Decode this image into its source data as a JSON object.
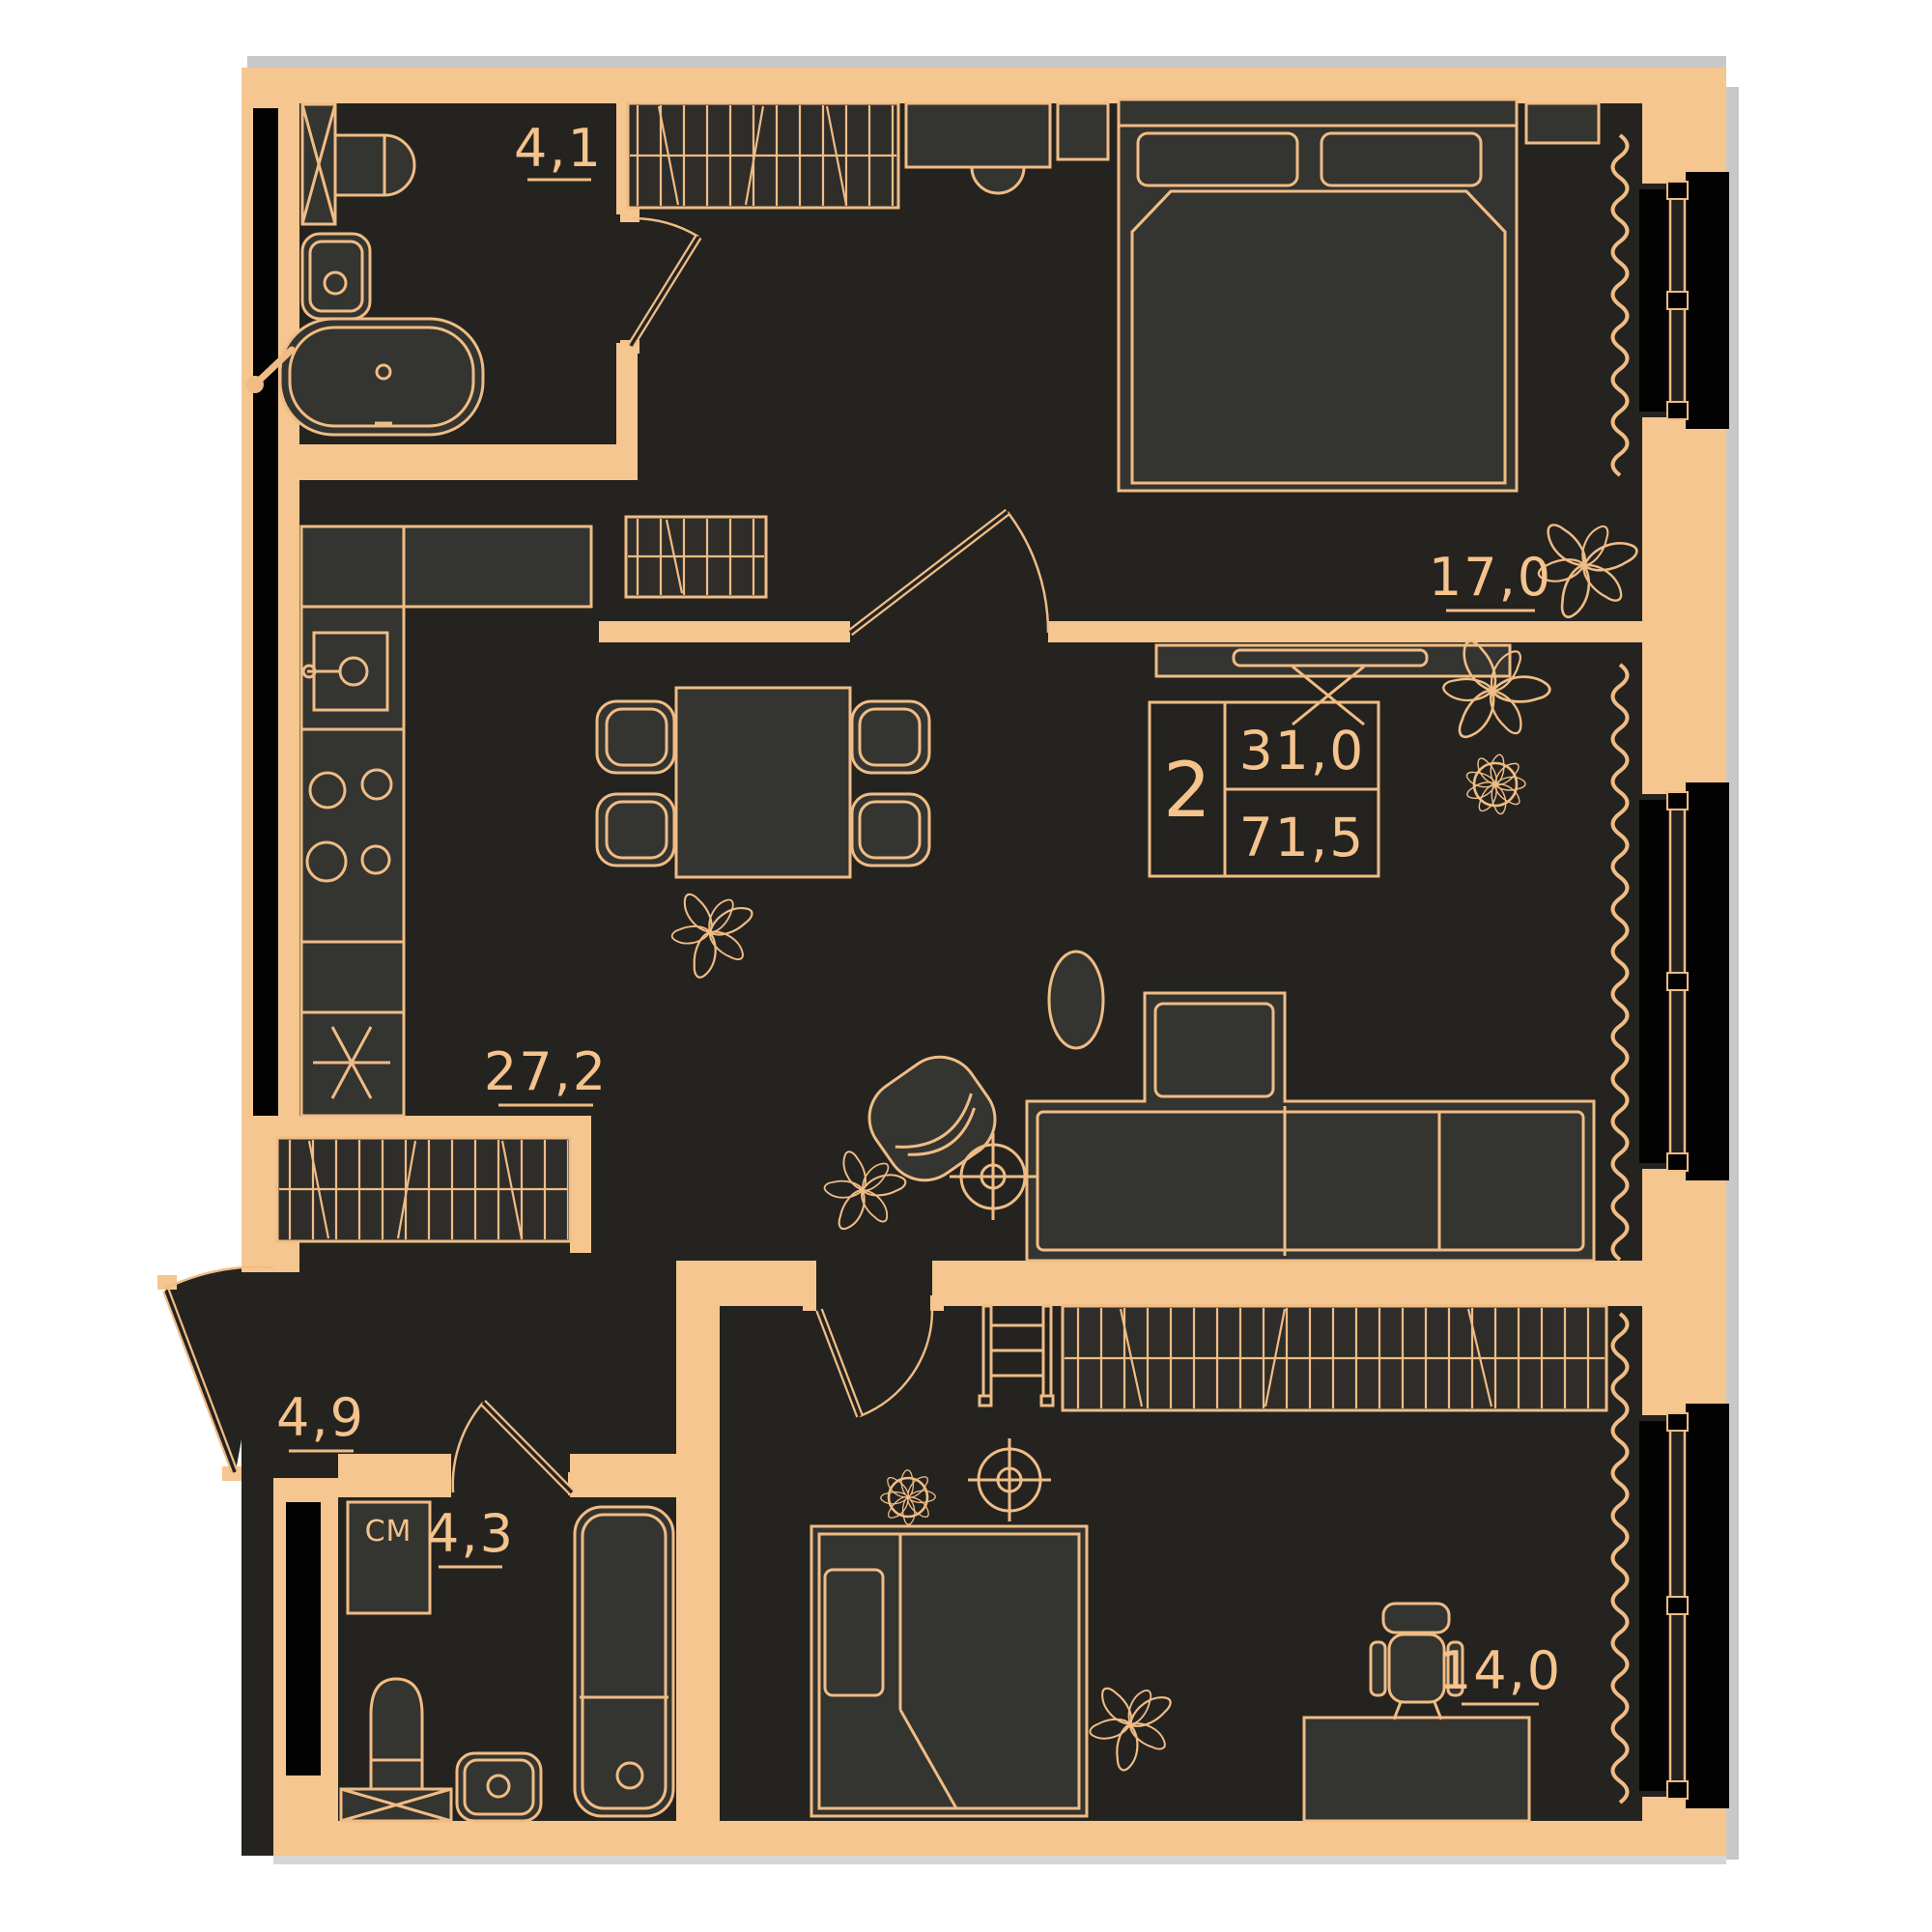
{
  "plan": {
    "title": "apartment-floor-plan",
    "unit_info": {
      "rooms": "2",
      "area_living": "31,0",
      "area_total": "71,5"
    },
    "room_areas": {
      "bathroom1": "4,1",
      "bedroom1": "17,0",
      "kitchen_living": "27,2",
      "hallway": "4,9",
      "bathroom2": "4,3",
      "bedroom2": "14,0"
    },
    "labels": {
      "washer": "СМ"
    },
    "colors": {
      "wall": "#F5C68F",
      "line": "#F0BC85",
      "floor": "#242320",
      "furniture": "#343430",
      "window_black": "#020202",
      "shadow": "#C8C8C8",
      "background": "#FFFFFF"
    }
  }
}
